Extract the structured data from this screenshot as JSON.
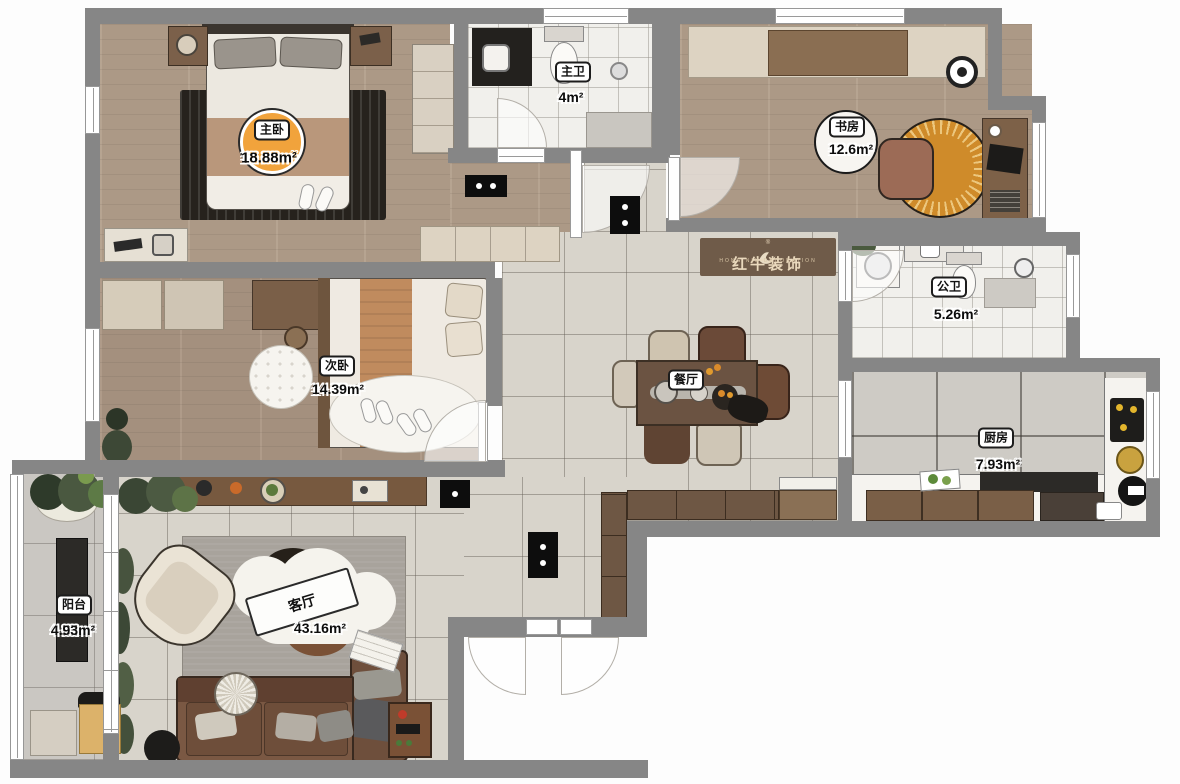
{
  "logo": {
    "brand": "红牛装饰",
    "subtitle": "HONG NIU DECORATION",
    "registered": "®"
  },
  "rooms": {
    "master_bedroom": {
      "name": "主卧",
      "area": "18.88m²"
    },
    "master_bathroom": {
      "name": "主卫",
      "area": "4m²"
    },
    "study": {
      "name": "书房",
      "area": "12.6m²"
    },
    "guest_bathroom": {
      "name": "公卫",
      "area": "5.26m²"
    },
    "second_bedroom": {
      "name": "次卧",
      "area": "14.39m²"
    },
    "dining_room": {
      "name": "餐厅"
    },
    "kitchen": {
      "name": "厨房",
      "area": "7.93m²"
    },
    "balcony": {
      "name": "阳台",
      "area": "4.93m²"
    },
    "living_room": {
      "name": "客厅",
      "area": "43.16m²"
    }
  },
  "colors": {
    "wall": "#868686",
    "accent_orange": "#f1a33c",
    "rug_orange": "#cf8b2a",
    "wood": "#b29e8a",
    "tile": "#d8d4cb"
  }
}
